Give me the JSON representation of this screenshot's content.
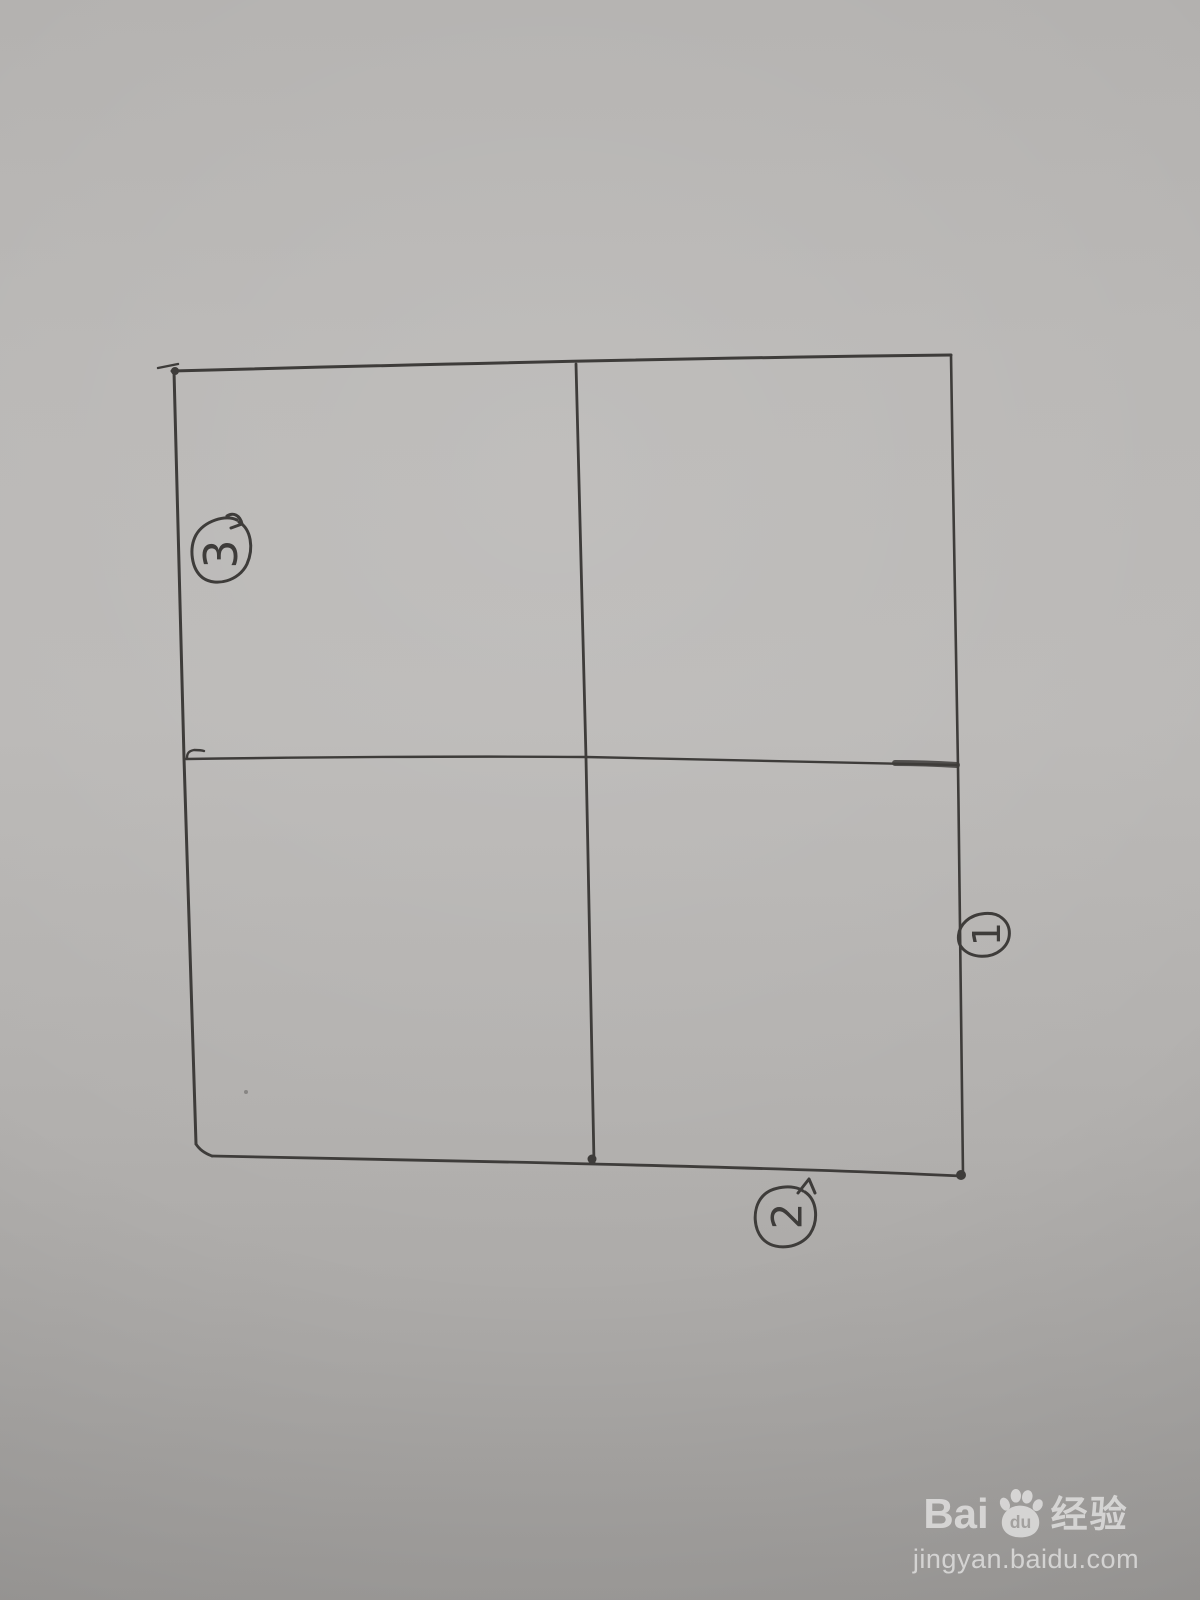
{
  "sketch": {
    "label_top_left": "3",
    "label_right": "1",
    "label_bottom": "2"
  },
  "watermark": {
    "brand_bai": "Bai",
    "brand_du": "du",
    "brand_cn": "经验",
    "url": "jingyan.baidu.com"
  },
  "colors": {
    "pen": "#3e3c3a",
    "paper": "#b4b2b0",
    "watermark": "#ffffff"
  }
}
